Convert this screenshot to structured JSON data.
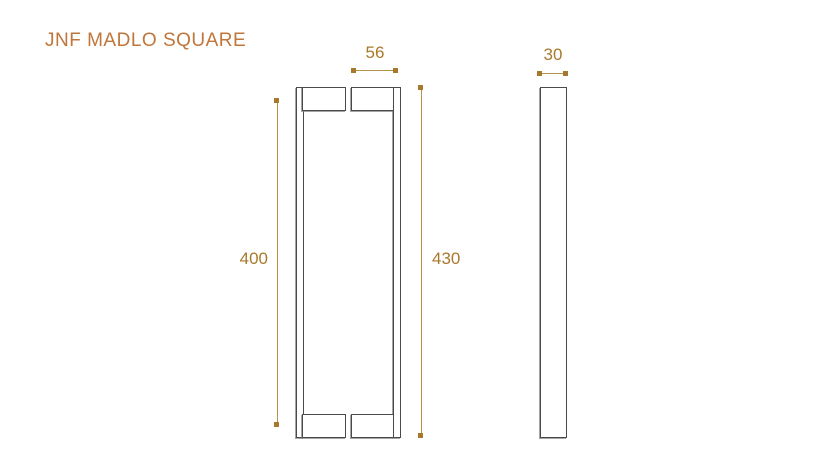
{
  "title": "JNF MADLO SQUARE",
  "dimensions": {
    "front_pair_depth": "56",
    "front_fixing_spacing": "400",
    "front_total_height": "430",
    "side_bar_width": "30"
  },
  "colors": {
    "background": "#ffffff",
    "title_text": "#c0763a",
    "dimension_text": "#a8792c",
    "dimension_line": "#b6954a",
    "part_outline": "#4a4a4a"
  }
}
